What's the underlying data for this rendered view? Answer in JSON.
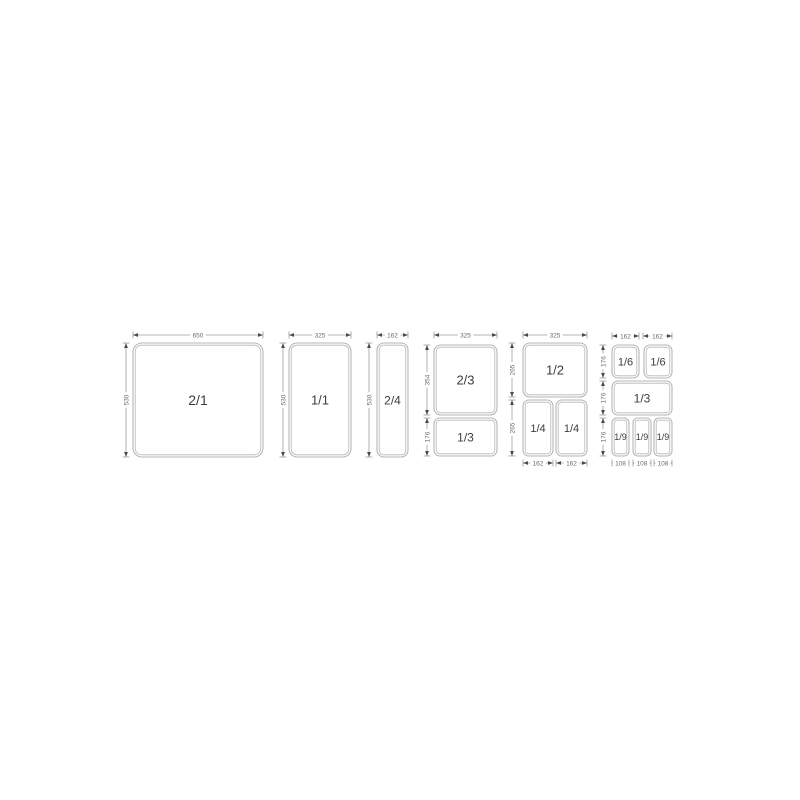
{
  "page": {
    "background_color": "#ffffff"
  },
  "diagram": {
    "description_label": "gastronorm-pan-size-diagram",
    "colors": {
      "background": "#ffffff",
      "pan_line": "#b6b6b6",
      "dim_line": "#9e9e9e",
      "arrow": "#4a4a4a",
      "dim_text": "#6b6b6b",
      "pan_text": "#3c3c3c"
    },
    "panels": [
      {
        "id": "2-1",
        "pans": [
          {
            "label": "2/1",
            "x": 133,
            "y": 343,
            "w": 130,
            "h": 114,
            "r": 9,
            "fs": 14
          }
        ],
        "dims": [
          {
            "value": "650",
            "o": "h",
            "a": 133,
            "b": 263,
            "p": 335
          },
          {
            "value": "530",
            "o": "v",
            "a": 343,
            "b": 457,
            "p": 126
          }
        ]
      },
      {
        "id": "1-1",
        "pans": [
          {
            "label": "1/1",
            "x": 289,
            "y": 343,
            "w": 62,
            "h": 114,
            "r": 8,
            "fs": 13
          }
        ],
        "dims": [
          {
            "value": "325",
            "o": "h",
            "a": 289,
            "b": 351,
            "p": 335
          },
          {
            "value": "530",
            "o": "v",
            "a": 343,
            "b": 457,
            "p": 283
          }
        ]
      },
      {
        "id": "2-4",
        "pans": [
          {
            "label": "2/4",
            "x": 377,
            "y": 343,
            "w": 31,
            "h": 114,
            "r": 7,
            "fs": 12
          }
        ],
        "dims": [
          {
            "value": "162",
            "o": "h",
            "a": 377,
            "b": 408,
            "p": 335
          },
          {
            "value": "530",
            "o": "v",
            "a": 343,
            "b": 457,
            "p": 369
          }
        ]
      },
      {
        "id": "2-3_1-3",
        "pans": [
          {
            "label": "2/3",
            "x": 434,
            "y": 345,
            "w": 63,
            "h": 70,
            "r": 7,
            "fs": 13
          },
          {
            "label": "1/3",
            "x": 434,
            "y": 418,
            "w": 63,
            "h": 38,
            "r": 6,
            "fs": 12
          }
        ],
        "dims": [
          {
            "value": "325",
            "o": "h",
            "a": 434,
            "b": 497,
            "p": 335
          },
          {
            "value": "354",
            "o": "v",
            "a": 345,
            "b": 415,
            "p": 427
          },
          {
            "value": "176",
            "o": "v",
            "a": 418,
            "b": 456,
            "p": 427
          }
        ]
      },
      {
        "id": "1-2_1-4",
        "pans": [
          {
            "label": "1/2",
            "x": 523,
            "y": 343,
            "w": 64,
            "h": 54,
            "r": 7,
            "fs": 13
          },
          {
            "label": "1/4",
            "x": 523,
            "y": 400,
            "w": 30,
            "h": 56,
            "r": 6,
            "fs": 11
          },
          {
            "label": "1/4",
            "x": 556,
            "y": 400,
            "w": 31,
            "h": 56,
            "r": 6,
            "fs": 11
          }
        ],
        "dims": [
          {
            "value": "325",
            "o": "h",
            "a": 523,
            "b": 587,
            "p": 335
          },
          {
            "value": "265",
            "o": "v",
            "a": 343,
            "b": 397,
            "p": 512
          },
          {
            "value": "265",
            "o": "v",
            "a": 400,
            "b": 456,
            "p": 512
          },
          {
            "value": "162",
            "o": "h",
            "a": 523,
            "b": 553,
            "p": 463
          },
          {
            "value": "162",
            "o": "h",
            "a": 556,
            "b": 587,
            "p": 463
          }
        ]
      },
      {
        "id": "1-6_1-3_1-9",
        "pans": [
          {
            "label": "1/6",
            "x": 612,
            "y": 345,
            "w": 27,
            "h": 33,
            "r": 6,
            "fs": 11
          },
          {
            "label": "1/6",
            "x": 644,
            "y": 345,
            "w": 28,
            "h": 33,
            "r": 6,
            "fs": 11
          },
          {
            "label": "1/3",
            "x": 612,
            "y": 381,
            "w": 60,
            "h": 34,
            "r": 6,
            "fs": 12
          },
          {
            "label": "1/9",
            "x": 612,
            "y": 418,
            "w": 17,
            "h": 38,
            "r": 5,
            "fs": 9
          },
          {
            "label": "1/9",
            "x": 633,
            "y": 418,
            "w": 18,
            "h": 38,
            "r": 5,
            "fs": 9
          },
          {
            "label": "1/9",
            "x": 654,
            "y": 418,
            "w": 18,
            "h": 38,
            "r": 5,
            "fs": 9
          }
        ],
        "dims": [
          {
            "value": "162",
            "o": "h",
            "a": 612,
            "b": 639,
            "p": 336
          },
          {
            "value": "162",
            "o": "h",
            "a": 643,
            "b": 672,
            "p": 336
          },
          {
            "value": "176",
            "o": "v",
            "a": 345,
            "b": 378,
            "p": 603
          },
          {
            "value": "176",
            "o": "v",
            "a": 381,
            "b": 415,
            "p": 603
          },
          {
            "value": "176",
            "o": "v",
            "a": 418,
            "b": 456,
            "p": 603
          },
          {
            "value": "108",
            "o": "h",
            "a": 612,
            "b": 629,
            "p": 463
          },
          {
            "value": "108",
            "o": "h",
            "a": 633,
            "b": 651,
            "p": 463
          },
          {
            "value": "108",
            "o": "h",
            "a": 654,
            "b": 672,
            "p": 463
          }
        ]
      }
    ]
  }
}
